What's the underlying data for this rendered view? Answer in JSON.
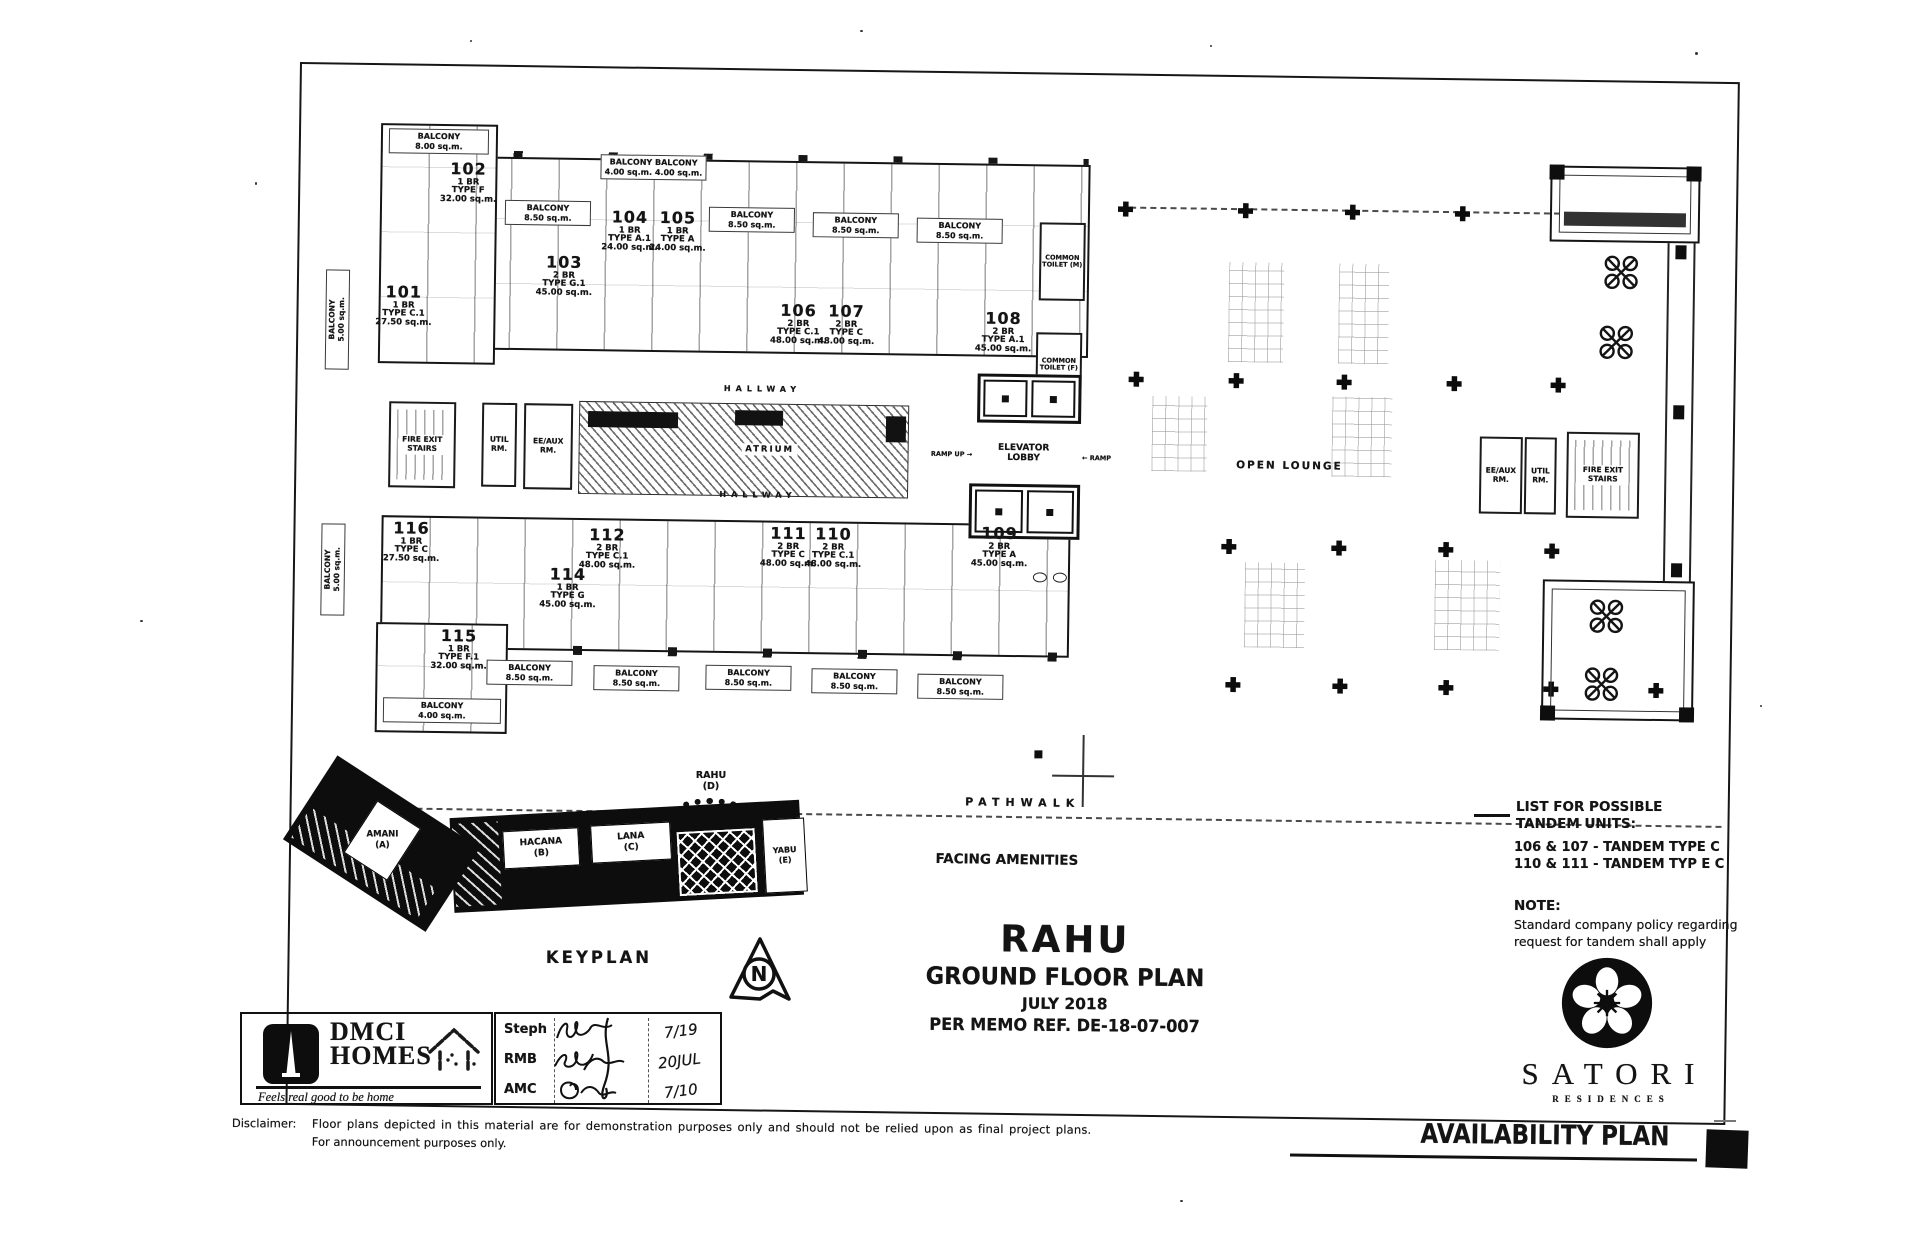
{
  "document": {
    "availability_title": "AVAILABILITY PLAN",
    "disclaimer_label": "Disclaimer:",
    "disclaimer_line1": "Floor plans depicted in this material are for demonstration purposes only and should not be relied upon as final project plans.",
    "disclaimer_line2": "For announcement purposes only."
  },
  "title_block": {
    "project": "RAHU",
    "plan": "GROUND FLOOR PLAN",
    "date": "JULY 2018",
    "memo": "PER MEMO REF. DE-18-07-007"
  },
  "branding": {
    "dmci_line1": "DMCI",
    "dmci_line2": "HOMES",
    "dmci_tagline": "Feels real good to be home",
    "satori": "SATORI",
    "satori_sub": "RESIDENCES"
  },
  "signoff": {
    "rows": [
      {
        "label": "Steph",
        "date": "7/19"
      },
      {
        "label": "RMB",
        "date": "20JUL"
      },
      {
        "label": "AMC",
        "date": "7/10"
      }
    ]
  },
  "tandem": {
    "heading1": "LIST FOR POSSIBLE",
    "heading2": "TANDEM UNITS:",
    "item1": "106 & 107 - TANDEM TYPE C",
    "item2": "110 & 111 - TANDEM TYP E C",
    "note_label": "NOTE:",
    "note1": "Standard company policy regarding",
    "note2": "request for tandem shall apply"
  },
  "keyplan": {
    "label": "KEYPLAN",
    "north": "N",
    "buildings": {
      "amani": "AMANI",
      "amani_code": "(A)",
      "hacana": "HACANA",
      "hacana_code": "(B)",
      "lana": "LANA",
      "lana_code": "(C)",
      "rahu": "RAHU",
      "rahu_code": "(D)",
      "yabu": "YABU",
      "yabu_code": "(E)"
    }
  },
  "areas": {
    "hallway_top": "HALLWAY",
    "hallway_bottom": "HALLWAY",
    "atrium": "ATRIUM",
    "elevator_lobby": "ELEVATOR LOBBY",
    "ramp_up": "RAMP UP",
    "ramp": "RAMP",
    "open_lounge": "OPEN LOUNGE",
    "pathwalk": "PATHWALK",
    "facing_amenities": "FACING AMENITIES",
    "fire_exit_left": "FIRE EXIT STAIRS",
    "util_left": "UTIL RM.",
    "eeaux_left": "EE/AUX RM.",
    "fire_exit_right": "FIRE EXIT STAIRS",
    "util_right": "UTIL RM.",
    "eeaux_right": "EE/AUX RM.",
    "toilet_m": "COMMON TOILET (M)",
    "toilet_f": "COMMON TOILET (F)"
  },
  "icons": {
    "ramp_up_arrow": "→",
    "ramp_arrow": "←"
  },
  "units": [
    {
      "number": "101",
      "br": "1 BR",
      "type": "TYPE C.1",
      "area": "27.50 sq.m."
    },
    {
      "number": "102",
      "br": "1 BR",
      "type": "TYPE F",
      "area": "32.00 sq.m."
    },
    {
      "number": "103",
      "br": "2 BR",
      "type": "TYPE G.1",
      "area": "45.00 sq.m."
    },
    {
      "number": "104",
      "br": "1 BR",
      "type": "TYPE A.1",
      "area": "24.00 sq.m."
    },
    {
      "number": "105",
      "br": "1 BR",
      "type": "TYPE A",
      "area": "24.00 sq.m."
    },
    {
      "number": "106",
      "br": "2 BR",
      "type": "TYPE C.1",
      "area": "48.00 sq.m."
    },
    {
      "number": "107",
      "br": "2 BR",
      "type": "TYPE C",
      "area": "48.00 sq.m."
    },
    {
      "number": "108",
      "br": "2 BR",
      "type": "TYPE A.1",
      "area": "45.00 sq.m."
    },
    {
      "number": "109",
      "br": "2 BR",
      "type": "TYPE A",
      "area": "45.00 sq.m."
    },
    {
      "number": "110",
      "br": "2 BR",
      "type": "TYPE C.1",
      "area": "48.00 sq.m."
    },
    {
      "number": "111",
      "br": "2 BR",
      "type": "TYPE C",
      "area": "48.00 sq.m."
    },
    {
      "number": "112",
      "br": "2 BR",
      "type": "TYPE C.1",
      "area": "48.00 sq.m."
    },
    {
      "number": "114",
      "br": "1 BR",
      "type": "TYPE G",
      "area": "45.00 sq.m."
    },
    {
      "number": "115",
      "br": "1 BR",
      "type": "TYPE F.1",
      "area": "32.00 sq.m."
    },
    {
      "number": "116",
      "br": "1 BR",
      "type": "TYPE C",
      "area": "27.50 sq.m."
    }
  ],
  "balconies": [
    {
      "label": "BALCONY",
      "size": "8.00 sq.m."
    },
    {
      "label": "BALCONY  BALCONY",
      "size": "4.00 sq.m.  4.00 sq.m."
    },
    {
      "label": "BALCONY",
      "size": "8.50 sq.m."
    },
    {
      "label": "BALCONY",
      "size": "8.50 sq.m."
    },
    {
      "label": "BALCONY",
      "size": "8.50 sq.m."
    },
    {
      "label": "BALCONY",
      "size": "8.50 sq.m."
    },
    {
      "label": "BALCONY",
      "size": "5.00 sq.m."
    },
    {
      "label": "BALCONY",
      "size": "5.00 sq.m."
    },
    {
      "label": "BALCONY",
      "size": "8.50 sq.m."
    },
    {
      "label": "BALCONY",
      "size": "8.50 sq.m."
    },
    {
      "label": "BALCONY",
      "size": "8.50 sq.m."
    },
    {
      "label": "BALCONY",
      "size": "8.50 sq.m."
    },
    {
      "label": "BALCONY",
      "size": "8.50 sq.m."
    },
    {
      "label": "BALCONY",
      "size": "4.00 sq.m."
    }
  ]
}
